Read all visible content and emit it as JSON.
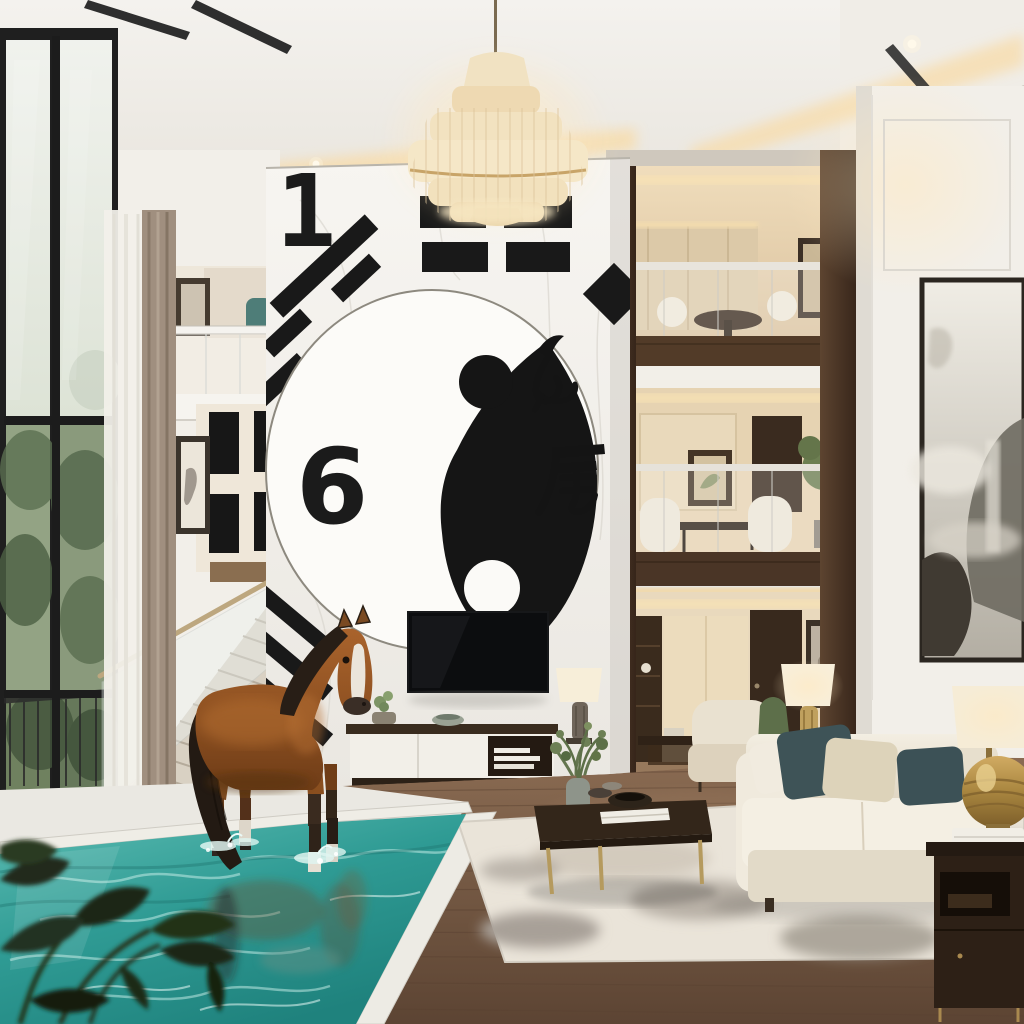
{
  "scene": {
    "description": "Photorealistic double-height luxury living room with an indoor turquoise pool, a bay horse standing in the water, a giant marble feature wall bearing a yin-yang symbol, I-Ching style black bars, the numbers 1 and 6 and Chinese calligraphy, a tiered chandelier, a staircase with glass railing, three warm-lit mezzanine levels, cream sofa seating and an ink-wash landscape painting",
    "style": "architectural interior render"
  },
  "feature_wall": {
    "number_top": "1",
    "number_middle": "6",
    "character_right": "尾",
    "character_inner_cursive": "九",
    "motifs": [
      "yin-yang circle",
      "broken hexagram bars",
      "diagonal trigram stripes",
      "diamond accent"
    ],
    "marble_color": "#f5f3ee",
    "graphic_color": "#1a1a1a"
  },
  "media_wall": {
    "tv": "wall-mounted black flat screen",
    "console": "white drawer console with dark wood top, cactus pot, bowl and white books"
  },
  "pool": {
    "water_color": "#2f9b94",
    "caustics_color": "#cdf2ec",
    "coping": "white stone edge"
  },
  "horse": {
    "coat": "bay chestnut",
    "mane_tail": "black",
    "markings": "white blaze and white socks",
    "position": "standing in the pool facing right"
  },
  "living_area": {
    "sofa": "cream three-seat sofa",
    "pillows": [
      "dark teal",
      "beige",
      "dark teal"
    ],
    "coffee_table": "dark wood top with brass legs, white books, bowls and a green sprig vase",
    "rug": "cream rug with grey abstract wash",
    "armchair": "cream accent chair",
    "side_table": "dark wood table with brass legs and white books"
  },
  "lighting": {
    "chandelier": "tiered cream crystal chandelier on a cord",
    "cove_glow_color": "#f6ddab",
    "lamps": [
      "ribbed brass table lamp with cream shade",
      "gold orb table lamp with cream drum shade"
    ]
  },
  "right_wall_art": {
    "type": "ink-wash mountain landscape",
    "frame": "thin black frame"
  },
  "windows": {
    "frame": "black steel grid",
    "view": "misty green hillside with balcony rail",
    "curtains": [
      "white sheer",
      "taupe drape"
    ]
  },
  "mezzanine": {
    "levels": 3,
    "materials": [
      "dark walnut posts",
      "glass railings",
      "walnut floor slabs"
    ],
    "contents": [
      "round table lounge",
      "dining nook with potted tree",
      "study nook with desk and lamp"
    ],
    "glow": "#f6ddab"
  }
}
